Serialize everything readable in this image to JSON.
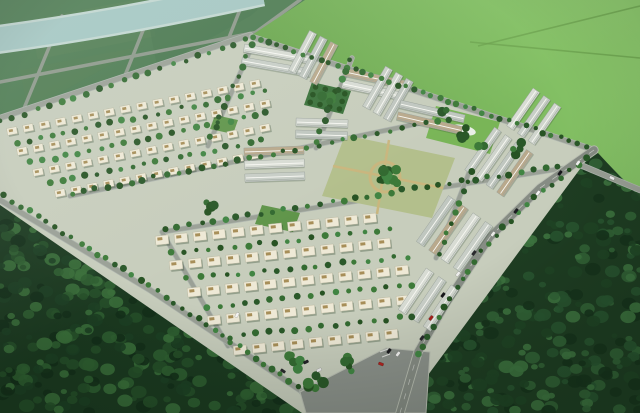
{
  "scene": {
    "canvas": {
      "w": 640,
      "h": 413
    },
    "palette": {
      "base_green": "#3f6b44",
      "farmland": "#4d7b51",
      "farm_road": "#8d988a",
      "river_shore": "#c3d7d1",
      "river_water": "#a5c7c3",
      "field_bright_hi": "#8ecb6e",
      "field_bright_lo": "#68a44b",
      "field_track": "#699f4c",
      "forest_sw_base": "#1b3a20",
      "forest_se_base": "#1e3d22",
      "forest_sw_blobs": [
        "#14301a",
        "#1d4023",
        "#265029",
        "#2f5f31",
        "#3a6f3a"
      ],
      "forest_se_blobs": [
        "#16331c",
        "#1f4425",
        "#285430",
        "#326336",
        "#3d733f"
      ],
      "estate_ground": "#c7cdbc",
      "street": "#9aa096",
      "street_edge": "#aeb5ae",
      "main_road": "#868c84",
      "main_road_curb": "#b9beb2",
      "road_dash": "#d8dbd4",
      "boulevard": "#8b918a",
      "crosswalk": "#e8e8e4",
      "roof_colors": [
        "#d8dcd4",
        "#c8cec7",
        "#d0d5cd",
        "#c0c7c0",
        "#b9a98c"
      ],
      "roof_ridge": "#f8f8f3",
      "roof_eave": "#9aa29b",
      "villa_body": "#eee9d6",
      "villa_stroke": "#b5b29a",
      "villa_box": "#a78e58",
      "villa_shadow": "#1c351c",
      "tree_colors": [
        "#2a5829",
        "#336a31",
        "#3d7a39",
        "#275323",
        "#418543"
      ],
      "park_lawn": "#79b557",
      "park_tree_grid": "#3a713a",
      "park_tree_grid_dot": "#24511f",
      "park_central_ground": "#b3bf8c",
      "park_path": "#c9b67e",
      "pond": "#e9efe7",
      "pocket_park": "#60954a",
      "vignette": "rgba(8,20,10,0.22)",
      "haze": "rgba(215,230,225,0.16)"
    },
    "regions": {
      "farmland_poly": [
        [
          0,
          0
        ],
        [
          312,
          0
        ],
        [
          252,
          35
        ],
        [
          0,
          118
        ]
      ],
      "field_poly": [
        [
          305,
          0
        ],
        [
          640,
          0
        ],
        [
          640,
          196
        ],
        [
          594,
          150
        ],
        [
          252,
          35
        ]
      ],
      "forest_sw_poly": [
        [
          0,
          196
        ],
        [
          160,
          292
        ],
        [
          305,
          395
        ],
        [
          330,
          413
        ],
        [
          0,
          413
        ]
      ],
      "forest_se_poly": [
        [
          598,
          153
        ],
        [
          545,
          192
        ],
        [
          490,
          242
        ],
        [
          448,
          305
        ],
        [
          420,
          356
        ],
        [
          408,
          413
        ],
        [
          640,
          413
        ],
        [
          640,
          198
        ]
      ],
      "estate_poly": [
        [
          0,
          118
        ],
        [
          250,
          35
        ],
        [
          594,
          150
        ],
        [
          400,
          413
        ],
        [
          302,
          413
        ],
        [
          0,
          205
        ]
      ],
      "river_path": "M -6,40 C 70,30 150,16 262,-8",
      "river_width": 24,
      "river_shore_width": 29
    },
    "farm_roads": [
      [
        [
          0,
          46
        ],
        [
          248,
          0
        ]
      ],
      [
        [
          0,
          82
        ],
        [
          330,
          18
        ]
      ],
      [
        [
          62,
          16
        ],
        [
          20,
          118
        ]
      ],
      [
        [
          152,
          8
        ],
        [
          112,
          108
        ]
      ],
      [
        [
          243,
          2
        ],
        [
          205,
          98
        ]
      ],
      [
        [
          300,
          0
        ],
        [
          252,
          35
        ]
      ]
    ],
    "field_tracks": [
      [
        [
          478,
          46
        ],
        [
          640,
          6
        ]
      ],
      [
        [
          470,
          42
        ],
        [
          640,
          58
        ]
      ]
    ],
    "estate_streets": [
      {
        "pts": [
          [
            0,
            118
          ],
          [
            250,
            35
          ]
        ],
        "w": 5
      },
      {
        "pts": [
          [
            252,
            37
          ],
          [
            594,
            150
          ]
        ],
        "w": 5
      },
      {
        "pts": [
          [
            70,
            196
          ],
          [
            445,
            118
          ]
        ],
        "w": 4
      },
      {
        "pts": [
          [
            162,
            232
          ],
          [
            565,
            168
          ]
        ],
        "w": 4
      },
      {
        "pts": [
          [
            253,
            44
          ],
          [
            208,
            146
          ]
        ],
        "w": 4
      },
      {
        "pts": [
          [
            352,
            58
          ],
          [
            316,
            148
          ]
        ],
        "w": 4
      },
      {
        "pts": [
          [
            470,
            170
          ],
          [
            436,
            258
          ]
        ],
        "w": 4
      },
      {
        "pts": [
          [
            162,
            232
          ],
          [
            228,
            346
          ]
        ],
        "w": 4
      },
      {
        "pts": [
          [
            0,
            200
          ],
          [
            150,
            290
          ],
          [
            303,
            392
          ]
        ],
        "w": 5
      },
      {
        "pts": [
          [
            578,
            164
          ],
          [
            640,
            190
          ]
        ],
        "w": 5
      },
      {
        "pts": [
          [
            390,
            354
          ],
          [
            302,
            392
          ]
        ],
        "w": 5
      }
    ],
    "main_road": {
      "pts": [
        [
          594,
          150
        ],
        [
          540,
          188
        ],
        [
          490,
          237
        ],
        [
          448,
          300
        ],
        [
          418,
          352
        ],
        [
          400,
          413
        ]
      ],
      "w": 7.5
    },
    "boulevard_poly": [
      [
        300,
        392
      ],
      [
        386,
        348
      ],
      [
        430,
        352
      ],
      [
        426,
        413
      ],
      [
        306,
        413
      ]
    ],
    "crosswalk": [
      [
        [
          380,
          352
        ],
        [
          388,
          349
        ]
      ],
      [
        [
          382,
          357
        ],
        [
          390,
          354
        ]
      ]
    ],
    "villa_blocks": [
      {
        "angle": -11,
        "size": [
          10,
          7
        ],
        "box": [
          4,
          2.6
        ],
        "step": 16.5,
        "rows": [
          {
            "tip": [
              12,
              131
            ],
            "n": 16
          },
          {
            "tip": [
              22,
              151
            ],
            "n": 16
          },
          {
            "tip": [
              38,
              172
            ],
            "n": 15
          },
          {
            "tip": [
              60,
              193
            ],
            "n": 13
          }
        ]
      },
      {
        "angle": -6,
        "size": [
          13,
          9
        ],
        "box": [
          5,
          3
        ],
        "step": 19,
        "rows": [
          {
            "tip": [
              162,
              240
            ],
            "n": 12
          },
          {
            "tip": [
              176,
              265
            ],
            "n": 12
          },
          {
            "tip": [
              194,
              292
            ],
            "n": 12
          },
          {
            "tip": [
              214,
              320
            ],
            "n": 11
          },
          {
            "tip": [
              240,
              350
            ],
            "n": 9
          }
        ]
      }
    ],
    "strip_groups": [
      {
        "o": [
          244,
          48
        ],
        "a": 10,
        "n": 2,
        "len": 70,
        "w": 8,
        "gap": 13
      },
      {
        "o": [
          292,
          72
        ],
        "a": -62,
        "n": 3,
        "len": 45,
        "w": 8,
        "gap": 12
      },
      {
        "o": [
          345,
          72
        ],
        "a": 12,
        "n": 2,
        "len": 60,
        "w": 8,
        "gap": 12
      },
      {
        "o": [
          366,
          108
        ],
        "a": -60,
        "n": 3,
        "len": 46,
        "w": 8,
        "gap": 12
      },
      {
        "o": [
          400,
          104
        ],
        "a": 13,
        "n": 2,
        "len": 66,
        "w": 8,
        "gap": 12
      },
      {
        "o": [
          510,
          128
        ],
        "a": -55,
        "n": 3,
        "len": 46,
        "w": 8,
        "gap": 13
      },
      {
        "o": [
          296,
          122
        ],
        "a": 2,
        "n": 2,
        "len": 52,
        "w": 8,
        "gap": 12
      },
      {
        "o": [
          244,
          152
        ],
        "a": -2,
        "n": 3,
        "len": 60,
        "w": 8,
        "gap": 13
      },
      {
        "o": [
          468,
          172
        ],
        "a": -55,
        "n": 4,
        "len": 52,
        "w": 8,
        "gap": 13
      },
      {
        "o": [
          420,
          244
        ],
        "a": -55,
        "n": 4,
        "len": 56,
        "w": 9,
        "gap": 15
      },
      {
        "o": [
          402,
          312
        ],
        "a": -56,
        "n": 3,
        "len": 50,
        "w": 9,
        "gap": 15
      }
    ],
    "parks": {
      "tree_grid": {
        "poly": [
          [
            312,
            82
          ],
          [
            351,
            91
          ],
          [
            343,
            114
          ],
          [
            304,
            105
          ]
        ],
        "rows": 3,
        "cols": 4
      },
      "lawn": {
        "poly": [
          [
            436,
            106
          ],
          [
            500,
            122
          ],
          [
            490,
            154
          ],
          [
            426,
            138
          ]
        ],
        "pond": {
          "cx": 463,
          "cy": 130,
          "rx": 13,
          "ry": 5,
          "rot": 12
        }
      },
      "central": {
        "poly": [
          [
            345,
            135
          ],
          [
            455,
            158
          ],
          [
            432,
            218
          ],
          [
            322,
            196
          ]
        ],
        "ring": {
          "cx": 385,
          "cy": 177,
          "r": 15
        },
        "paths": [
          [
            [
              333,
              166
            ],
            [
              443,
              188
            ]
          ],
          [
            [
              389,
              140
            ],
            [
              377,
              214
            ]
          ]
        ]
      },
      "pockets": [
        [
          [
            262,
            205
          ],
          [
            300,
            213
          ],
          [
            293,
            232
          ],
          [
            255,
            224
          ]
        ],
        [
          [
            215,
            115
          ],
          [
            238,
            120
          ],
          [
            233,
            134
          ],
          [
            210,
            129
          ]
        ]
      ]
    },
    "tree_lines": [
      {
        "pts": [
          [
            0,
            122
          ],
          [
            250,
            39
          ]
        ],
        "gap": 13
      },
      {
        "pts": [
          [
            252,
            37
          ],
          [
            592,
            148
          ]
        ],
        "gap": 9
      },
      {
        "pts": [
          [
            4,
            196
          ],
          [
            150,
            286
          ],
          [
            300,
            388
          ]
        ],
        "gap": 10
      },
      {
        "pts": [
          [
            588,
            158
          ],
          [
            536,
            196
          ],
          [
            486,
            245
          ],
          [
            444,
            308
          ],
          [
            416,
            358
          ]
        ],
        "gap": 11
      },
      {
        "pts": [
          [
            17,
            143
          ],
          [
            268,
            90
          ]
        ],
        "gap": 12
      },
      {
        "pts": [
          [
            31,
            163
          ],
          [
            272,
            112
          ]
        ],
        "gap": 12
      },
      {
        "pts": [
          [
            50,
            184
          ],
          [
            262,
            140
          ]
        ],
        "gap": 12
      },
      {
        "pts": [
          [
            170,
            253
          ],
          [
            400,
            229
          ]
        ],
        "gap": 13
      },
      {
        "pts": [
          [
            187,
            279
          ],
          [
            412,
            256
          ]
        ],
        "gap": 13
      },
      {
        "pts": [
          [
            206,
            307
          ],
          [
            420,
            284
          ]
        ],
        "gap": 13
      },
      {
        "pts": [
          [
            231,
            337
          ],
          [
            424,
            315
          ]
        ],
        "gap": 13
      },
      {
        "pts": [
          [
            72,
            194
          ],
          [
            442,
            120
          ]
        ],
        "gap": 12
      },
      {
        "pts": [
          [
            166,
            228
          ],
          [
            558,
            166
          ]
        ],
        "gap": 12
      },
      {
        "pts": [
          [
            251,
            46
          ],
          [
            208,
            144
          ]
        ],
        "gap": 11
      },
      {
        "pts": [
          [
            350,
            60
          ],
          [
            314,
            146
          ]
        ],
        "gap": 11
      },
      {
        "pts": [
          [
            472,
            172
          ],
          [
            438,
            256
          ]
        ],
        "gap": 11
      }
    ],
    "tree_clusters": [
      {
        "x": 318,
        "y": 382,
        "n": 6,
        "r": 11
      },
      {
        "x": 348,
        "y": 366,
        "n": 5,
        "r": 9
      },
      {
        "x": 293,
        "y": 362,
        "n": 5,
        "r": 9
      },
      {
        "x": 385,
        "y": 177,
        "n": 12,
        "r": 15
      },
      {
        "x": 208,
        "y": 208,
        "n": 4,
        "r": 8
      },
      {
        "x": 462,
        "y": 136,
        "n": 4,
        "r": 9
      },
      {
        "x": 447,
        "y": 116,
        "n": 3,
        "r": 7
      },
      {
        "x": 484,
        "y": 146,
        "n": 3,
        "r": 7
      },
      {
        "x": 330,
        "y": 96,
        "n": 4,
        "r": 8
      },
      {
        "x": 520,
        "y": 150,
        "n": 4,
        "r": 9
      }
    ],
    "forest": {
      "blob_count": 270,
      "r_min": 3,
      "r_max": 8
    },
    "cars": [
      {
        "x": 578,
        "y": 163,
        "c": "#f0f0ee",
        "a": 127
      },
      {
        "x": 560,
        "y": 173,
        "c": "#16161a",
        "a": 127
      },
      {
        "x": 538,
        "y": 193,
        "c": "#f2f2f0",
        "a": 127
      },
      {
        "x": 516,
        "y": 211,
        "c": "#1d1d22",
        "a": 127
      },
      {
        "x": 493,
        "y": 234,
        "c": "#ebebe8",
        "a": 127
      },
      {
        "x": 474,
        "y": 253,
        "c": "#2a2a2e",
        "a": 127
      },
      {
        "x": 458,
        "y": 274,
        "c": "#eeeeec",
        "a": 127
      },
      {
        "x": 443,
        "y": 295,
        "c": "#16161a",
        "a": 127
      },
      {
        "x": 431,
        "y": 318,
        "c": "#a8221c",
        "a": 127
      },
      {
        "x": 422,
        "y": 338,
        "c": "#28282c",
        "a": 127
      },
      {
        "x": 389,
        "y": 351,
        "c": "#1a1a1e",
        "a": 127
      },
      {
        "x": 398,
        "y": 354,
        "c": "#f2f2f0",
        "a": 127
      },
      {
        "x": 381,
        "y": 364,
        "c": "#b02420",
        "a": 20
      },
      {
        "x": 306,
        "y": 362,
        "c": "#232328",
        "a": -25
      },
      {
        "x": 319,
        "y": 370,
        "c": "#eeeeee",
        "a": -25
      },
      {
        "x": 237,
        "y": 315,
        "c": "#f4f4f2",
        "a": -64
      },
      {
        "x": 283,
        "y": 371,
        "c": "#2a2a2e",
        "a": 33
      },
      {
        "x": 612,
        "y": 178,
        "c": "#f0f0f0",
        "a": 25
      }
    ]
  }
}
